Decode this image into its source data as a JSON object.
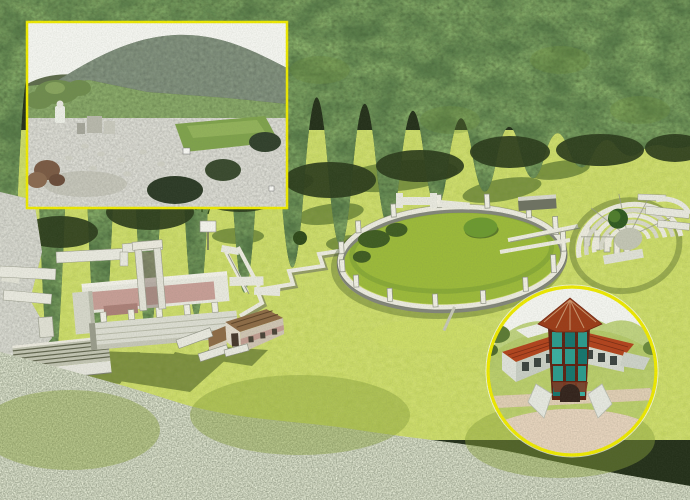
{
  "scene": {
    "palette": {
      "sky": "#f4f5f0",
      "forest": "#24301a",
      "forest_edge": "#2c3c1c",
      "grass": "#a9c43f",
      "grass_shadow": "#3a5a1e",
      "scrub": "#a8b08f",
      "rock": "#9aa08e",
      "stone": "#e9e9df",
      "stone_shade": "#8e9183",
      "temple_inner_wall": "#c79e96",
      "house_roof": "#8d6b46",
      "tree": "#2f5a20",
      "inset_border": "#eeea00",
      "museum_roof": "#b2431d",
      "museum_glass": "#2b9b8d",
      "gravel": "#c9b08e"
    },
    "insets": {
      "photo": {
        "border_color": "#eeea00",
        "marker_count": 2
      },
      "reconstruction": {
        "border_color": "#eeea00"
      }
    }
  }
}
